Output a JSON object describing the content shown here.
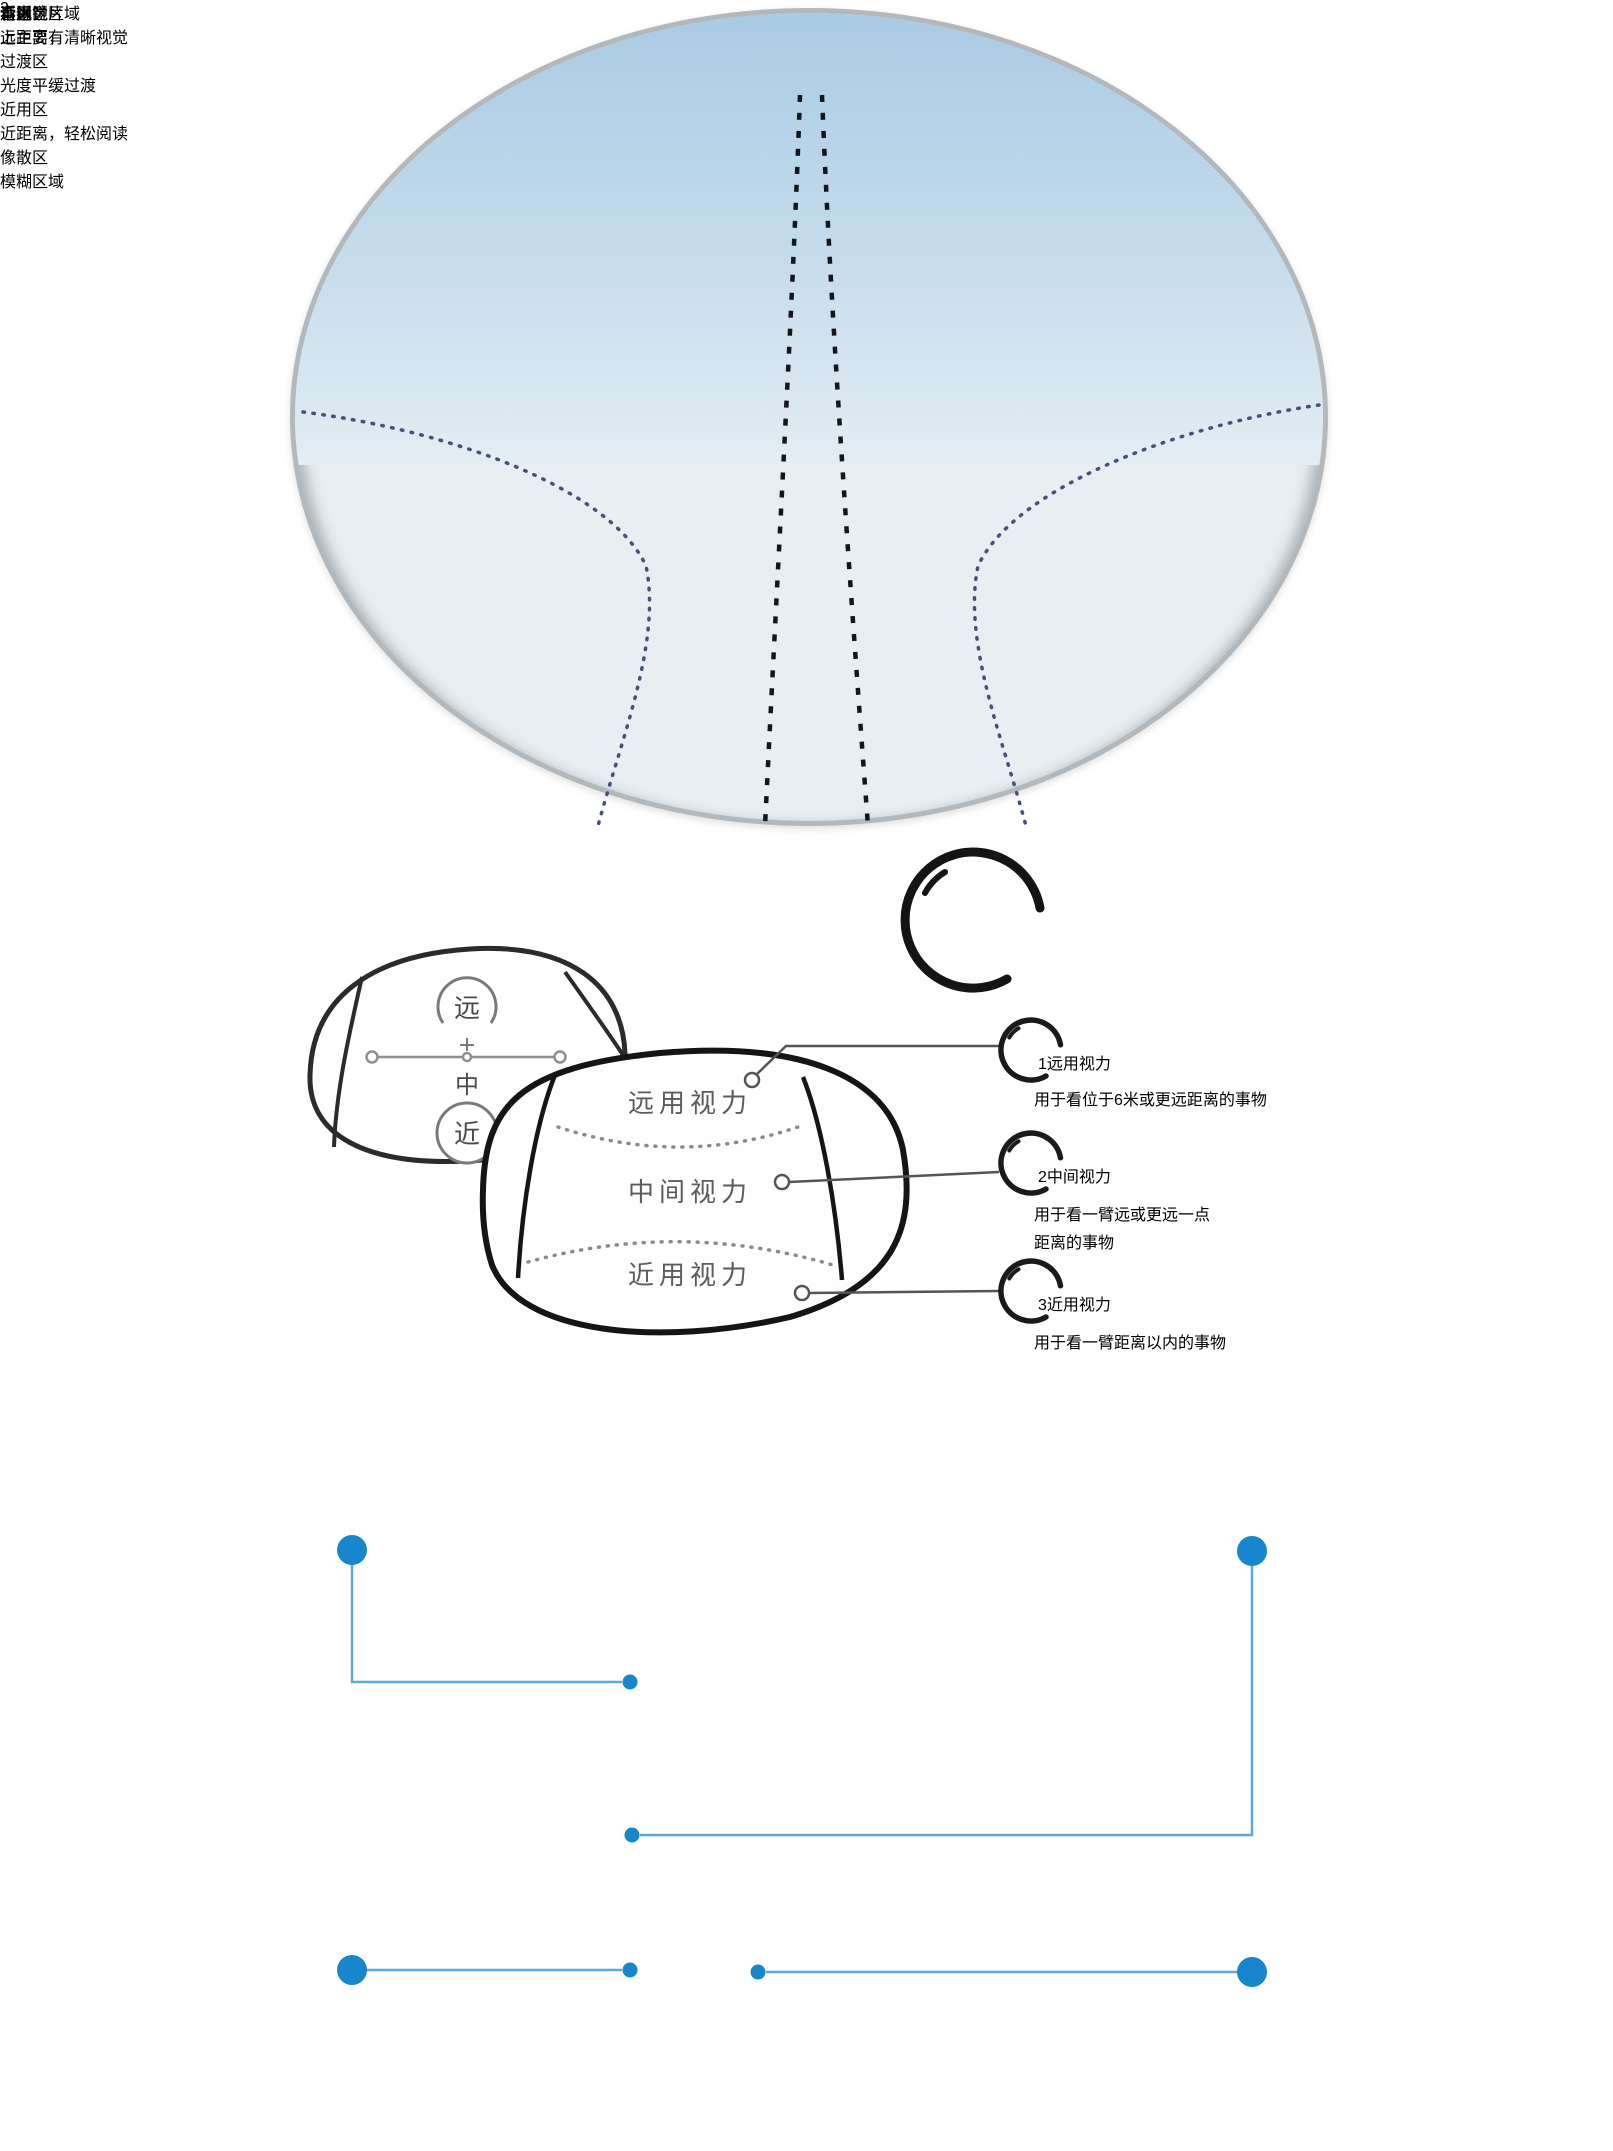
{
  "colors": {
    "accent_blue": "#1787cd",
    "connector_blue": "#5fa8d8",
    "label_blue": "#1a5fae",
    "blind_label_navy": "#15386e"
  },
  "top_lens": {
    "far_label": "看远",
    "mid_label": "看中",
    "near_label": "看近",
    "blind_left_label": "盲区",
    "blind_right_label": "盲区"
  },
  "middle_diagram": {
    "mini_lens": {
      "far": "远",
      "mid": "中",
      "near": "近"
    },
    "main_lens": {
      "far_zone": "远用视力",
      "mid_zone": "中间视力",
      "near_zone": "近用视力"
    },
    "headline": {
      "line1": "渐进镜片",
      "line2": "上主要有",
      "count": "3",
      "suffix": "个视觉区域"
    },
    "items": [
      {
        "num": "1",
        "title": "远用视力",
        "desc1": "用于看位于6米或更远距离的事物",
        "desc2": ""
      },
      {
        "num": "2",
        "title": "中间视力",
        "desc1": "用于看一臂远或更远一点",
        "desc2": "距离的事物"
      },
      {
        "num": "3",
        "title": "近用视力",
        "desc1": "用于看一臂距离以内的事物",
        "desc2": ""
      }
    ]
  },
  "bottom_zones": {
    "top_left": {
      "title": "远用区",
      "subtitle": "远距离，清晰视觉"
    },
    "top_right": {
      "title": "过渡区",
      "subtitle": "光度平缓过渡"
    },
    "bottom_left": {
      "title": "近用区",
      "subtitle": "近距离，轻松阅读"
    },
    "bottom_right": {
      "title": "像散区",
      "subtitle": "模糊区域"
    }
  }
}
